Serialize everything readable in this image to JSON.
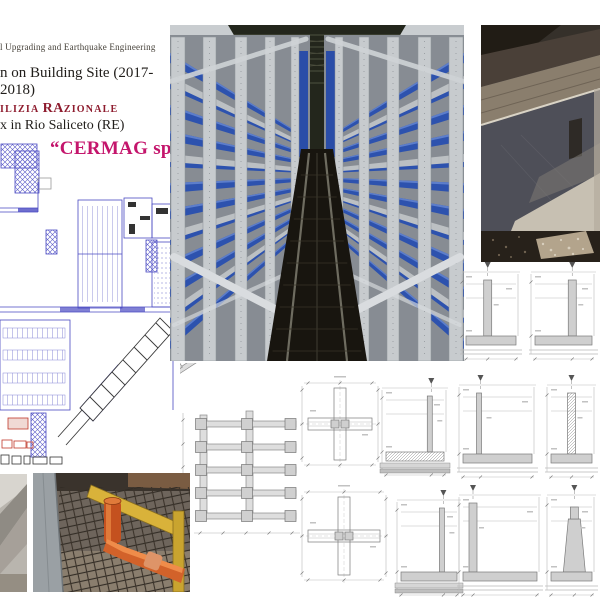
{
  "header": {
    "line1": "l Upgrading and Earthquake Engineering",
    "line2": "n on Building Site (2017-2018)",
    "line3": {
      "pre": "ILIZIA",
      "big": "RA",
      "post": "ZIONALE"
    },
    "line4": "x in Rio Saliceto (RE)",
    "client": "“CERMAG spa”"
  },
  "colors": {
    "accent_magenta": "#c4156c",
    "accent_dark_red": "#8e1c2e",
    "plan_blue": "#4a4ac2",
    "drawing_gray": "#8a8a8a",
    "rack_blue": "#2d52ae",
    "steel_gray": "#c7cbce",
    "pipe_orange": "#d2622a",
    "formwork_yellow": "#d9b23a"
  }
}
